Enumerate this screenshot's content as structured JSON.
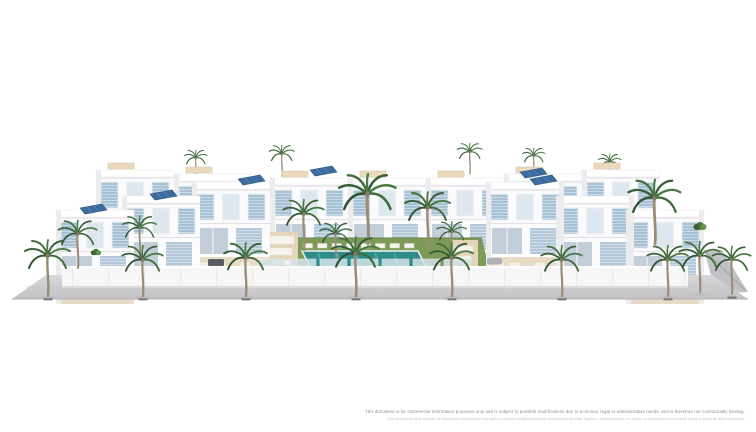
{
  "page": {
    "background": "#ffffff"
  },
  "rendering": {
    "description": "Aerial 3D rendering of a modern white residential development: two rows of flat-roofed townhouses with light-blue louvered windows and rooftop solar panels around a central communal garden with lawn, sun loungers and a turquoise swimming pool, fronted by a white perimeter wall and a palm-lined grey street.",
    "colors": {
      "building_white": "#fbfbfd",
      "shutter_blue": "#a6c0d4",
      "solar_panel_blue": "#3b6c9d",
      "lawn_green": "#7d9a58",
      "pool_teal": "#2e8c8a",
      "palm_green": "#4a7a44",
      "pavement_gray": "#cccccf",
      "terrace_beige": "#e9dcc7"
    }
  },
  "disclaimer": {
    "line1_en": "This document is for commercial information purposes only and is subject to possible modifications due to technical, legal or administrative needs, and is therefore not contractually binding.",
    "line2_es": "Este documento tiene carácter de información comercial y está sujeto a posibles modificaciones por necesidades técnicas, legales o administrativas, no siendo en consecuencia vinculante desde el punto de vista contractual."
  }
}
